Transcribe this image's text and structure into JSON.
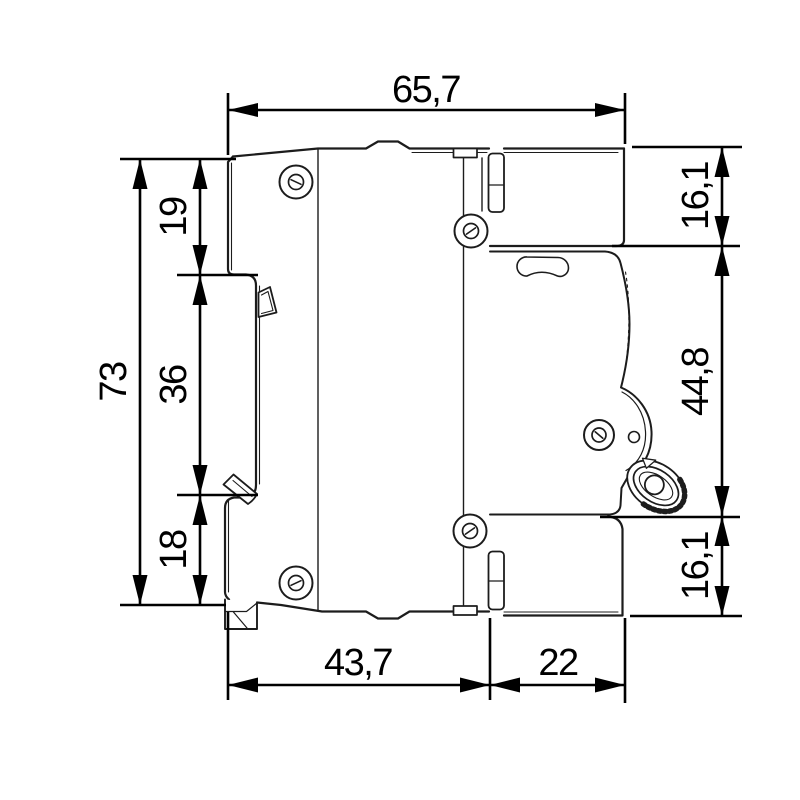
{
  "colors": {
    "background": "#ffffff",
    "outline": "#1c1c1c",
    "dimension": "#000000"
  },
  "dimensions": {
    "top_total_depth": "65,7",
    "left_total_height": "73",
    "left_top_segment": "19",
    "left_middle_segment": "36",
    "left_bottom_segment": "18",
    "right_top_segment": "16,1",
    "right_middle_segment": "44,8",
    "right_bottom_segment": "16,1",
    "bottom_rear_depth": "43,7",
    "bottom_front_depth": "22"
  }
}
